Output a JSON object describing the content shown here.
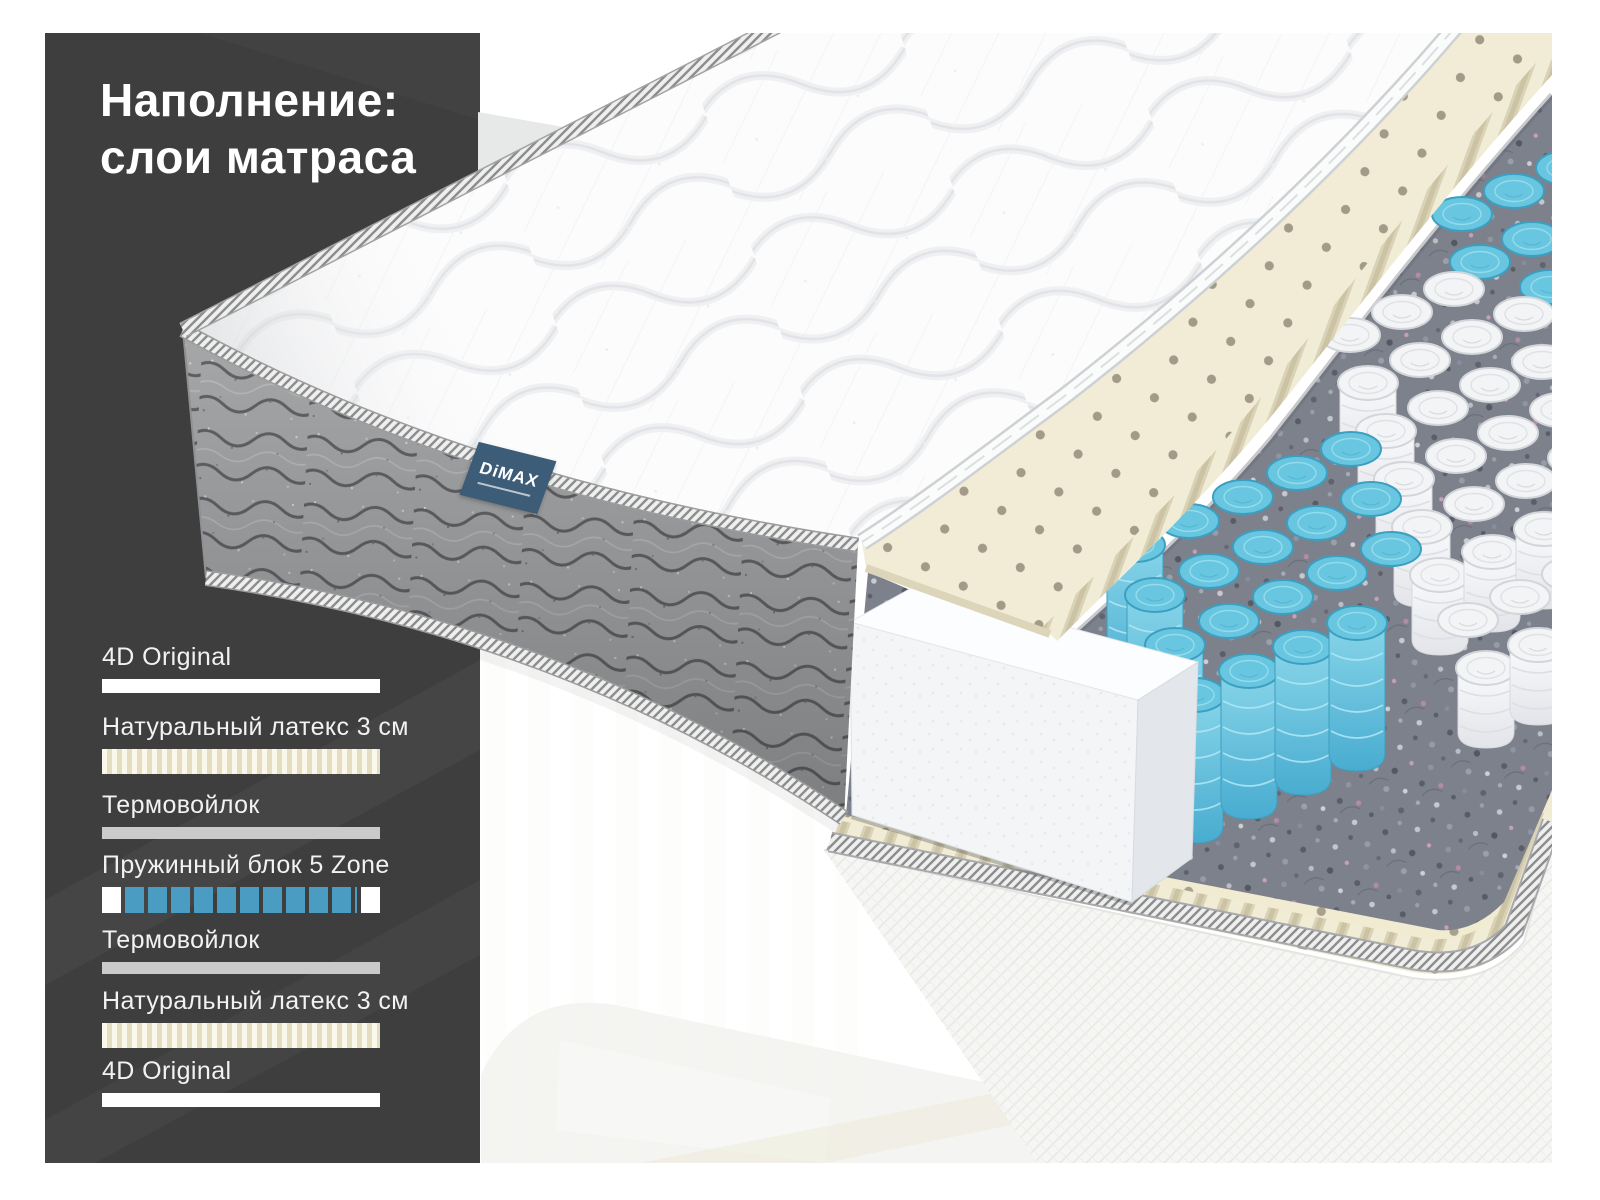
{
  "title": {
    "line1": "Наполнение:",
    "line2": "слои матраса"
  },
  "brand_tag": {
    "name": "DiMAX"
  },
  "legend": {
    "items": [
      {
        "label": "4D Original",
        "swatch": "white"
      },
      {
        "label": "Натуральный латекс 3 см",
        "swatch": "latex"
      },
      {
        "label": "Термовойлок",
        "swatch": "felt"
      },
      {
        "label": "Пружинный блок 5 Zone",
        "swatch": "springs"
      },
      {
        "label": "Термовойлок",
        "swatch": "felt"
      },
      {
        "label": "Натуральный латекс 3 см",
        "swatch": "latex"
      },
      {
        "label": "4D Original",
        "swatch": "white"
      }
    ]
  },
  "colors": {
    "panel_dark": "#3e3e3e",
    "spring_blue": "#4a9cc2",
    "spring_blue_3d": "#69c6e0",
    "latex_cream": "#f1ebd2",
    "felt_gray": "#7d818b",
    "tag_blue": "#3d5c78"
  }
}
